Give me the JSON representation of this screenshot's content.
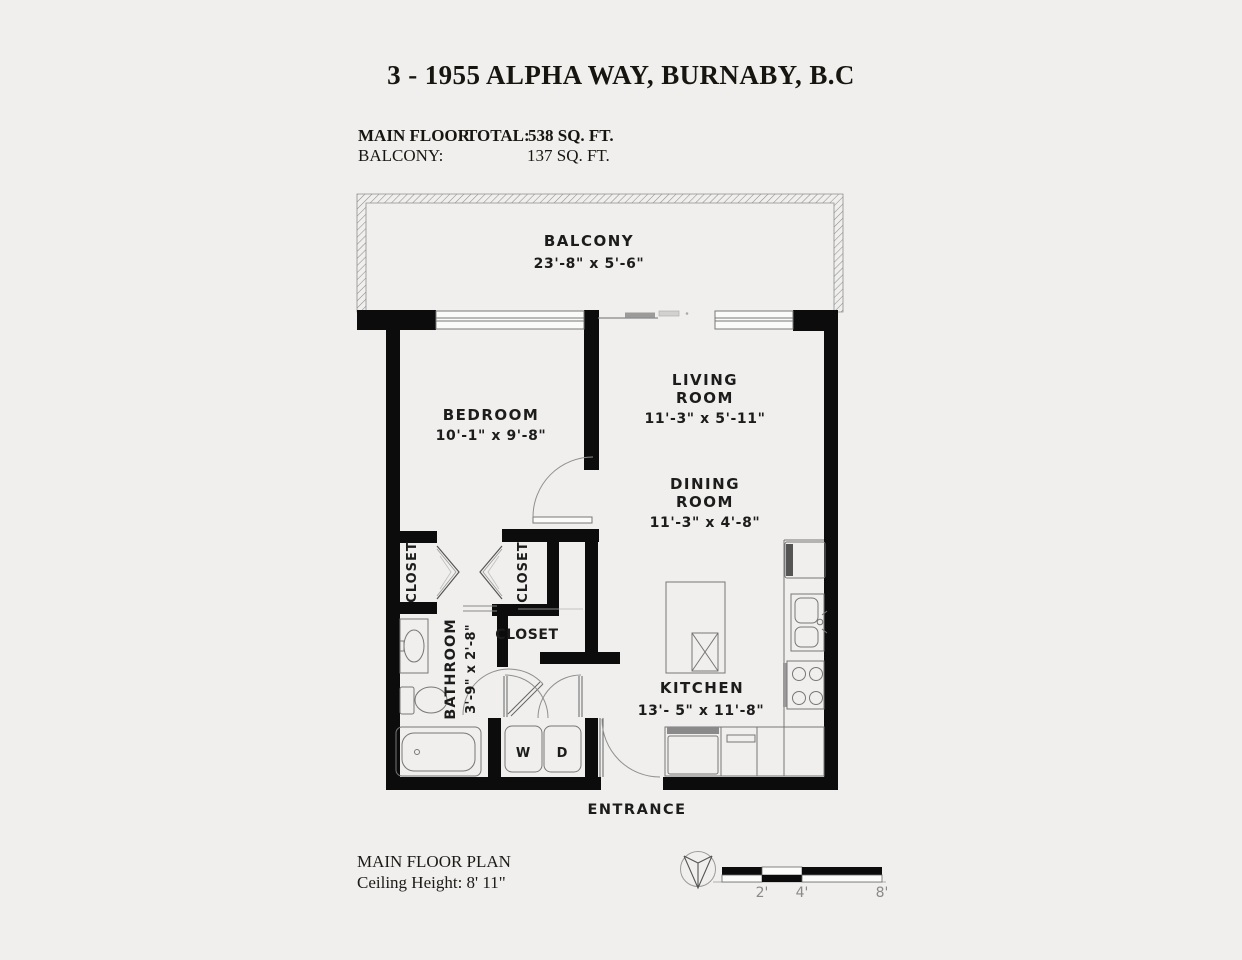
{
  "title": "3 - 1955 ALPHA WAY, BURNABY, B.C",
  "area_summary": {
    "main_floor_label": "MAIN FLOOR",
    "total_label": "TOTAL:",
    "main_floor_value": "538 SQ. FT.",
    "balcony_label": "BALCONY:",
    "balcony_value": "137 SQ. FT."
  },
  "rooms": {
    "balcony": {
      "name": "BALCONY",
      "dims": "23'-8\" x  5'-6\""
    },
    "bedroom": {
      "name": "BEDROOM",
      "dims": "10'-1\" x  9'-8\""
    },
    "living_room": {
      "name_line1": "LIVING",
      "name_line2": "ROOM",
      "dims": "11'-3\" x  5'-11\""
    },
    "dining_room": {
      "name_line1": "DINING",
      "name_line2": "ROOM",
      "dims": "11'-3\" x  4'-8\""
    },
    "kitchen": {
      "name": "KITCHEN",
      "dims": "13'- 5\" x  11'-8\""
    },
    "bathroom": {
      "name": "BATHROOM",
      "dims": "3'-9\" x 2'-8\""
    },
    "closet_left": {
      "name": "CLOSET"
    },
    "closet_right": {
      "name": "CLOSET"
    },
    "closet_entry": {
      "name": "CLOSET"
    },
    "washer": {
      "label": "W"
    },
    "dryer": {
      "label": "D"
    },
    "entrance": {
      "label": "ENTRANCE"
    }
  },
  "footer": {
    "plan_label": "MAIN FLOOR PLAN",
    "ceiling_height": "Ceiling Height: 8' 11\""
  },
  "scale_bar": {
    "labels": [
      "2'",
      "4'",
      "8'"
    ]
  },
  "colors": {
    "background": "#f0efed",
    "wall": "#0c0c0c",
    "line": "#777777",
    "text": "#1c1c1c"
  }
}
